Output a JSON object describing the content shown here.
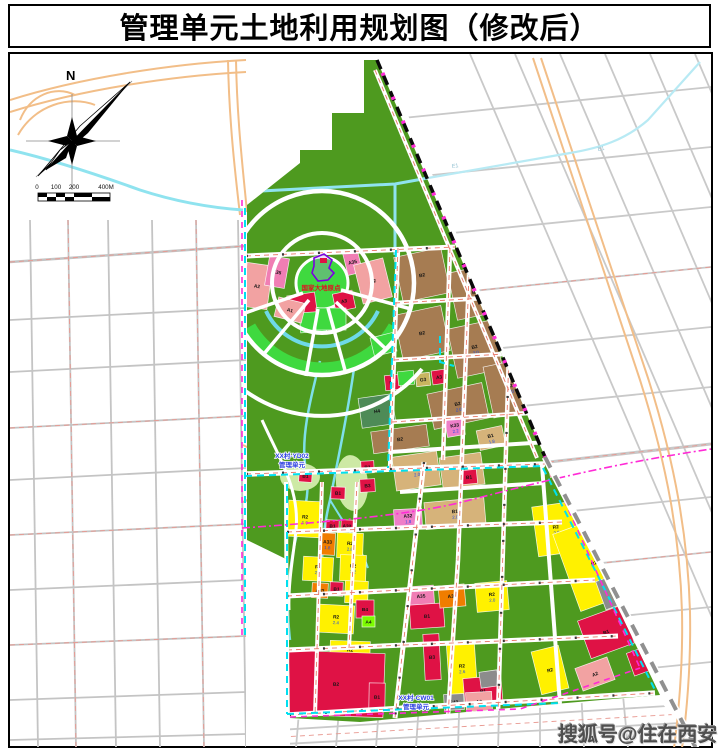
{
  "title": "管理单元土地利用规划图（修改后）",
  "compass": {
    "north_label": "N"
  },
  "scale_bar": {
    "labels": [
      "0",
      "100",
      "200",
      "400M"
    ]
  },
  "watermark": "搜狐号@住在西安",
  "map": {
    "landmark_label": "国家大地原点",
    "river_label": "E1",
    "unit_labels": [
      {
        "line1": "XX村-YD02",
        "line2": "管理单元"
      },
      {
        "line1": "XX村-CW01",
        "line2": "管理单元"
      }
    ],
    "palette": {
      "forest": "#4E9A1F",
      "bright_green": "#3FD93F",
      "pale_green": "#CDE9A5",
      "dark_sea_green": "#4E8B57",
      "salmon": "#F2A2A2",
      "pink": "#F07EB4",
      "magenta_pink": "#EE7EC8",
      "crimson": "#DF1245",
      "brown": "#A67C52",
      "tan": "#D6B37A",
      "yellow": "#FFF100",
      "orange": "#F07D00",
      "gray": "#8C8C8C",
      "khaki": "#C8B560",
      "lime": "#7CFC00",
      "river_cyan": "#8FE3EF",
      "unit_boundary_cyan": "#00E0F0",
      "rail_magenta": "#FF2BD6",
      "boundary_black": "#0A0A0A",
      "road_centerline_red": "#E87868",
      "grid_gray": "#C4C4C4",
      "highway_orange": "#F2BE88"
    },
    "zones": [
      {
        "c": "A2",
        "f": "",
        "x": 244,
        "y": 264,
        "w": 26,
        "h": 44,
        "r": 8,
        "k": "salmon"
      },
      {
        "c": "K35",
        "f": "",
        "x": 267,
        "y": 257,
        "w": 20,
        "h": 30,
        "r": 10,
        "k": "pink"
      },
      {
        "c": "B3",
        "f": "",
        "x": 288,
        "y": 294,
        "w": 28,
        "h": 20,
        "r": -8,
        "k": "crimson"
      },
      {
        "c": "",
        "f": "",
        "x": 300,
        "y": 312,
        "w": 26,
        "h": 20,
        "r": -4,
        "k": "bright_green"
      },
      {
        "c": "A3",
        "f": "",
        "x": 334,
        "y": 292,
        "w": 20,
        "h": 18,
        "r": -12,
        "k": "crimson"
      },
      {
        "c": "A35",
        "f": "",
        "x": 345,
        "y": 250,
        "w": 15,
        "h": 24,
        "r": -14,
        "k": "pink"
      },
      {
        "c": "A2",
        "f": "",
        "x": 358,
        "y": 261,
        "w": 30,
        "h": 40,
        "r": -14,
        "k": "salmon"
      },
      {
        "c": "A1",
        "f": "",
        "x": 276,
        "y": 300,
        "w": 28,
        "h": 20,
        "r": 14,
        "k": "salmon"
      },
      {
        "c": "",
        "f": "",
        "x": 316,
        "y": 308,
        "w": 30,
        "h": 22,
        "r": 0,
        "k": "bright_green"
      },
      {
        "c": "",
        "f": "",
        "x": 372,
        "y": 335,
        "w": 23,
        "h": 19,
        "r": -14,
        "k": "bright_green"
      },
      {
        "c": "B2",
        "f": "",
        "x": 398,
        "y": 252,
        "w": 48,
        "h": 46,
        "r": -12,
        "k": "brown"
      },
      {
        "c": "B2",
        "f": "",
        "x": 452,
        "y": 268,
        "w": 46,
        "h": 48,
        "r": -12,
        "k": "brown"
      },
      {
        "c": "B2",
        "f": "",
        "x": 510,
        "y": 302,
        "w": 30,
        "h": 50,
        "r": -12,
        "k": "brown"
      },
      {
        "c": "B2",
        "f": "",
        "x": 398,
        "y": 310,
        "w": 48,
        "h": 46,
        "r": -12,
        "k": "brown"
      },
      {
        "c": "B2",
        "f": "2.0",
        "x": 452,
        "y": 324,
        "w": 46,
        "h": 50,
        "r": -12,
        "k": "brown"
      },
      {
        "c": "B2",
        "f": "2.0",
        "x": 488,
        "y": 362,
        "w": 44,
        "h": 52,
        "r": -12,
        "k": "brown"
      },
      {
        "c": "B2",
        "f": "2.0",
        "x": 430,
        "y": 388,
        "w": 56,
        "h": 36,
        "r": -12,
        "k": "brown"
      },
      {
        "c": "B2",
        "f": "",
        "x": 372,
        "y": 428,
        "w": 56,
        "h": 22,
        "r": -8,
        "k": "brown"
      },
      {
        "c": "B1",
        "f": "",
        "x": 385,
        "y": 375,
        "w": 15,
        "h": 15,
        "r": -6,
        "k": "crimson"
      },
      {
        "c": "",
        "f": "",
        "x": 398,
        "y": 371,
        "w": 16,
        "h": 14,
        "r": -6,
        "k": "bright_green"
      },
      {
        "c": "G3",
        "f": "",
        "x": 416,
        "y": 373,
        "w": 14,
        "h": 13,
        "r": -6,
        "k": "khaki"
      },
      {
        "c": "A3",
        "f": "",
        "x": 432,
        "y": 370,
        "w": 14,
        "h": 14,
        "r": -8,
        "k": "crimson"
      },
      {
        "c": "H4",
        "f": "",
        "x": 360,
        "y": 396,
        "w": 34,
        "h": 30,
        "r": -8,
        "k": "dark_sea_green"
      },
      {
        "c": "K33",
        "f": "2.2",
        "x": 446,
        "y": 419,
        "w": 18,
        "h": 17,
        "r": -10,
        "k": "magenta_pink"
      },
      {
        "c": "B1",
        "f": "2.0",
        "x": 394,
        "y": 454,
        "w": 45,
        "h": 34,
        "r": -8,
        "k": "tan"
      },
      {
        "c": "B1",
        "f": "1.8",
        "x": 441,
        "y": 455,
        "w": 42,
        "h": 32,
        "r": -8,
        "k": "tan"
      },
      {
        "c": "B1",
        "f": "2.0",
        "x": 425,
        "y": 500,
        "w": 60,
        "h": 27,
        "r": -5,
        "k": "tan"
      },
      {
        "c": "B1",
        "f": "1.8",
        "x": 478,
        "y": 428,
        "w": 26,
        "h": 20,
        "r": -12,
        "k": "tan"
      },
      {
        "c": "B1",
        "f": "",
        "x": 461,
        "y": 470,
        "w": 16,
        "h": 14,
        "r": -6,
        "k": "crimson"
      },
      {
        "c": "B1",
        "f": "",
        "x": 549,
        "y": 461,
        "w": 17,
        "h": 15,
        "r": -10,
        "k": "crimson"
      },
      {
        "c": "A32",
        "f": "1.8",
        "x": 394,
        "y": 509,
        "w": 28,
        "h": 18,
        "r": -3,
        "k": "magenta_pink"
      },
      {
        "c": "B1",
        "f": "",
        "x": 299,
        "y": 470,
        "w": 13,
        "h": 12,
        "r": 4,
        "k": "crimson"
      },
      {
        "c": "B1",
        "f": "",
        "x": 361,
        "y": 461,
        "w": 13,
        "h": 12,
        "r": -3,
        "k": "crimson"
      },
      {
        "c": "B3",
        "f": "",
        "x": 360,
        "y": 479,
        "w": 15,
        "h": 13,
        "r": -3,
        "k": "crimson"
      },
      {
        "c": "B1",
        "f": "",
        "x": 331,
        "y": 487,
        "w": 14,
        "h": 12,
        "r": 2,
        "k": "crimson"
      },
      {
        "c": "B1",
        "f": "",
        "x": 326,
        "y": 520,
        "w": 13,
        "h": 12,
        "r": 2,
        "k": "crimson"
      },
      {
        "c": "A32",
        "f": "",
        "x": 341,
        "y": 520,
        "w": 12,
        "h": 12,
        "r": 2,
        "k": "crimson"
      },
      {
        "c": "R2",
        "f": "1.9",
        "x": 288,
        "y": 501,
        "w": 34,
        "h": 36,
        "r": 3,
        "k": "yellow"
      },
      {
        "c": "A33",
        "f": "1.8",
        "x": 320,
        "y": 533,
        "w": 15,
        "h": 22,
        "r": 3,
        "k": "orange"
      },
      {
        "c": "R2",
        "f": "2.8",
        "x": 337,
        "y": 533,
        "w": 26,
        "h": 25,
        "r": 2,
        "k": "yellow"
      },
      {
        "c": "R2",
        "f": "2.9",
        "x": 303,
        "y": 557,
        "w": 30,
        "h": 24,
        "r": 3,
        "k": "yellow"
      },
      {
        "c": "R2",
        "f": "3.2",
        "x": 340,
        "y": 555,
        "w": 26,
        "h": 26,
        "r": 2,
        "k": "yellow"
      },
      {
        "c": "A33",
        "f": "",
        "x": 312,
        "y": 583,
        "w": 16,
        "h": 15,
        "r": 3,
        "k": "orange"
      },
      {
        "c": "B1",
        "f": "",
        "x": 330,
        "y": 582,
        "w": 13,
        "h": 14,
        "r": 2,
        "k": "crimson"
      },
      {
        "c": "R2",
        "f": "",
        "x": 345,
        "y": 581,
        "w": 23,
        "h": 22,
        "r": 2,
        "k": "yellow"
      },
      {
        "c": "R2",
        "f": "2.4",
        "x": 318,
        "y": 605,
        "w": 36,
        "h": 28,
        "r": 3,
        "k": "yellow"
      },
      {
        "c": "B4",
        "f": "",
        "x": 356,
        "y": 600,
        "w": 18,
        "h": 18,
        "r": 0,
        "k": "crimson"
      },
      {
        "c": "A4",
        "f": "",
        "x": 362,
        "y": 616,
        "w": 13,
        "h": 11,
        "r": 0,
        "k": "lime"
      },
      {
        "c": "R2",
        "f": "2.2",
        "x": 330,
        "y": 641,
        "w": 40,
        "h": 22,
        "r": 2,
        "k": "yellow"
      },
      {
        "c": "B2",
        "f": "",
        "x": 288,
        "y": 652,
        "w": 96,
        "h": 64,
        "r": 2,
        "k": "crimson"
      },
      {
        "c": "B1",
        "f": "",
        "x": 369,
        "y": 683,
        "w": 16,
        "h": 28,
        "r": 1,
        "k": "crimson"
      },
      {
        "c": "A35",
        "f": "",
        "x": 408,
        "y": 586,
        "w": 26,
        "h": 20,
        "r": -4,
        "k": "pink"
      },
      {
        "c": "B1",
        "f": "",
        "x": 410,
        "y": 604,
        "w": 34,
        "h": 24,
        "r": -4,
        "k": "crimson"
      },
      {
        "c": "A33",
        "f": "",
        "x": 439,
        "y": 585,
        "w": 26,
        "h": 22,
        "r": -5,
        "k": "orange"
      },
      {
        "c": "R2",
        "f": "2.0",
        "x": 476,
        "y": 582,
        "w": 32,
        "h": 29,
        "r": -5,
        "k": "yellow"
      },
      {
        "c": "B3",
        "f": "",
        "x": 424,
        "y": 634,
        "w": 16,
        "h": 46,
        "r": -3,
        "k": "crimson"
      },
      {
        "c": "R2",
        "f": "2.6",
        "x": 448,
        "y": 642,
        "w": 28,
        "h": 52,
        "r": -4,
        "k": "yellow"
      },
      {
        "c": "B1",
        "f": "",
        "x": 464,
        "y": 677,
        "w": 38,
        "h": 28,
        "r": -5,
        "k": "crimson"
      },
      {
        "c": "S43",
        "f": "",
        "x": 444,
        "y": 694,
        "w": 20,
        "h": 16,
        "r": -3,
        "k": "gray"
      },
      {
        "c": "A2",
        "f": "",
        "x": 466,
        "y": 692,
        "w": 26,
        "h": 19,
        "r": -3,
        "k": "salmon"
      },
      {
        "c": "",
        "f": "",
        "x": 480,
        "y": 671,
        "w": 18,
        "h": 16,
        "r": -8,
        "k": "gray"
      },
      {
        "c": "R2",
        "f": "2.0",
        "x": 535,
        "y": 504,
        "w": 42,
        "h": 50,
        "r": -8,
        "k": "yellow"
      },
      {
        "c": "R2",
        "f": "",
        "x": 565,
        "y": 522,
        "w": 58,
        "h": 82,
        "r": -20,
        "k": "yellow"
      },
      {
        "c": "",
        "f": "",
        "x": 600,
        "y": 576,
        "w": 28,
        "h": 30,
        "r": -20,
        "k": "gray"
      },
      {
        "c": "B1",
        "f": "",
        "x": 583,
        "y": 612,
        "w": 46,
        "h": 40,
        "r": -20,
        "k": "crimson"
      },
      {
        "c": "",
        "f": "",
        "x": 630,
        "y": 650,
        "w": 16,
        "h": 24,
        "r": -20,
        "k": "crimson"
      },
      {
        "c": "A2",
        "f": "",
        "x": 578,
        "y": 662,
        "w": 34,
        "h": 24,
        "r": -20,
        "k": "salmon"
      },
      {
        "c": "R2",
        "f": "",
        "x": 536,
        "y": 648,
        "w": 28,
        "h": 44,
        "r": -14,
        "k": "yellow"
      }
    ]
  }
}
